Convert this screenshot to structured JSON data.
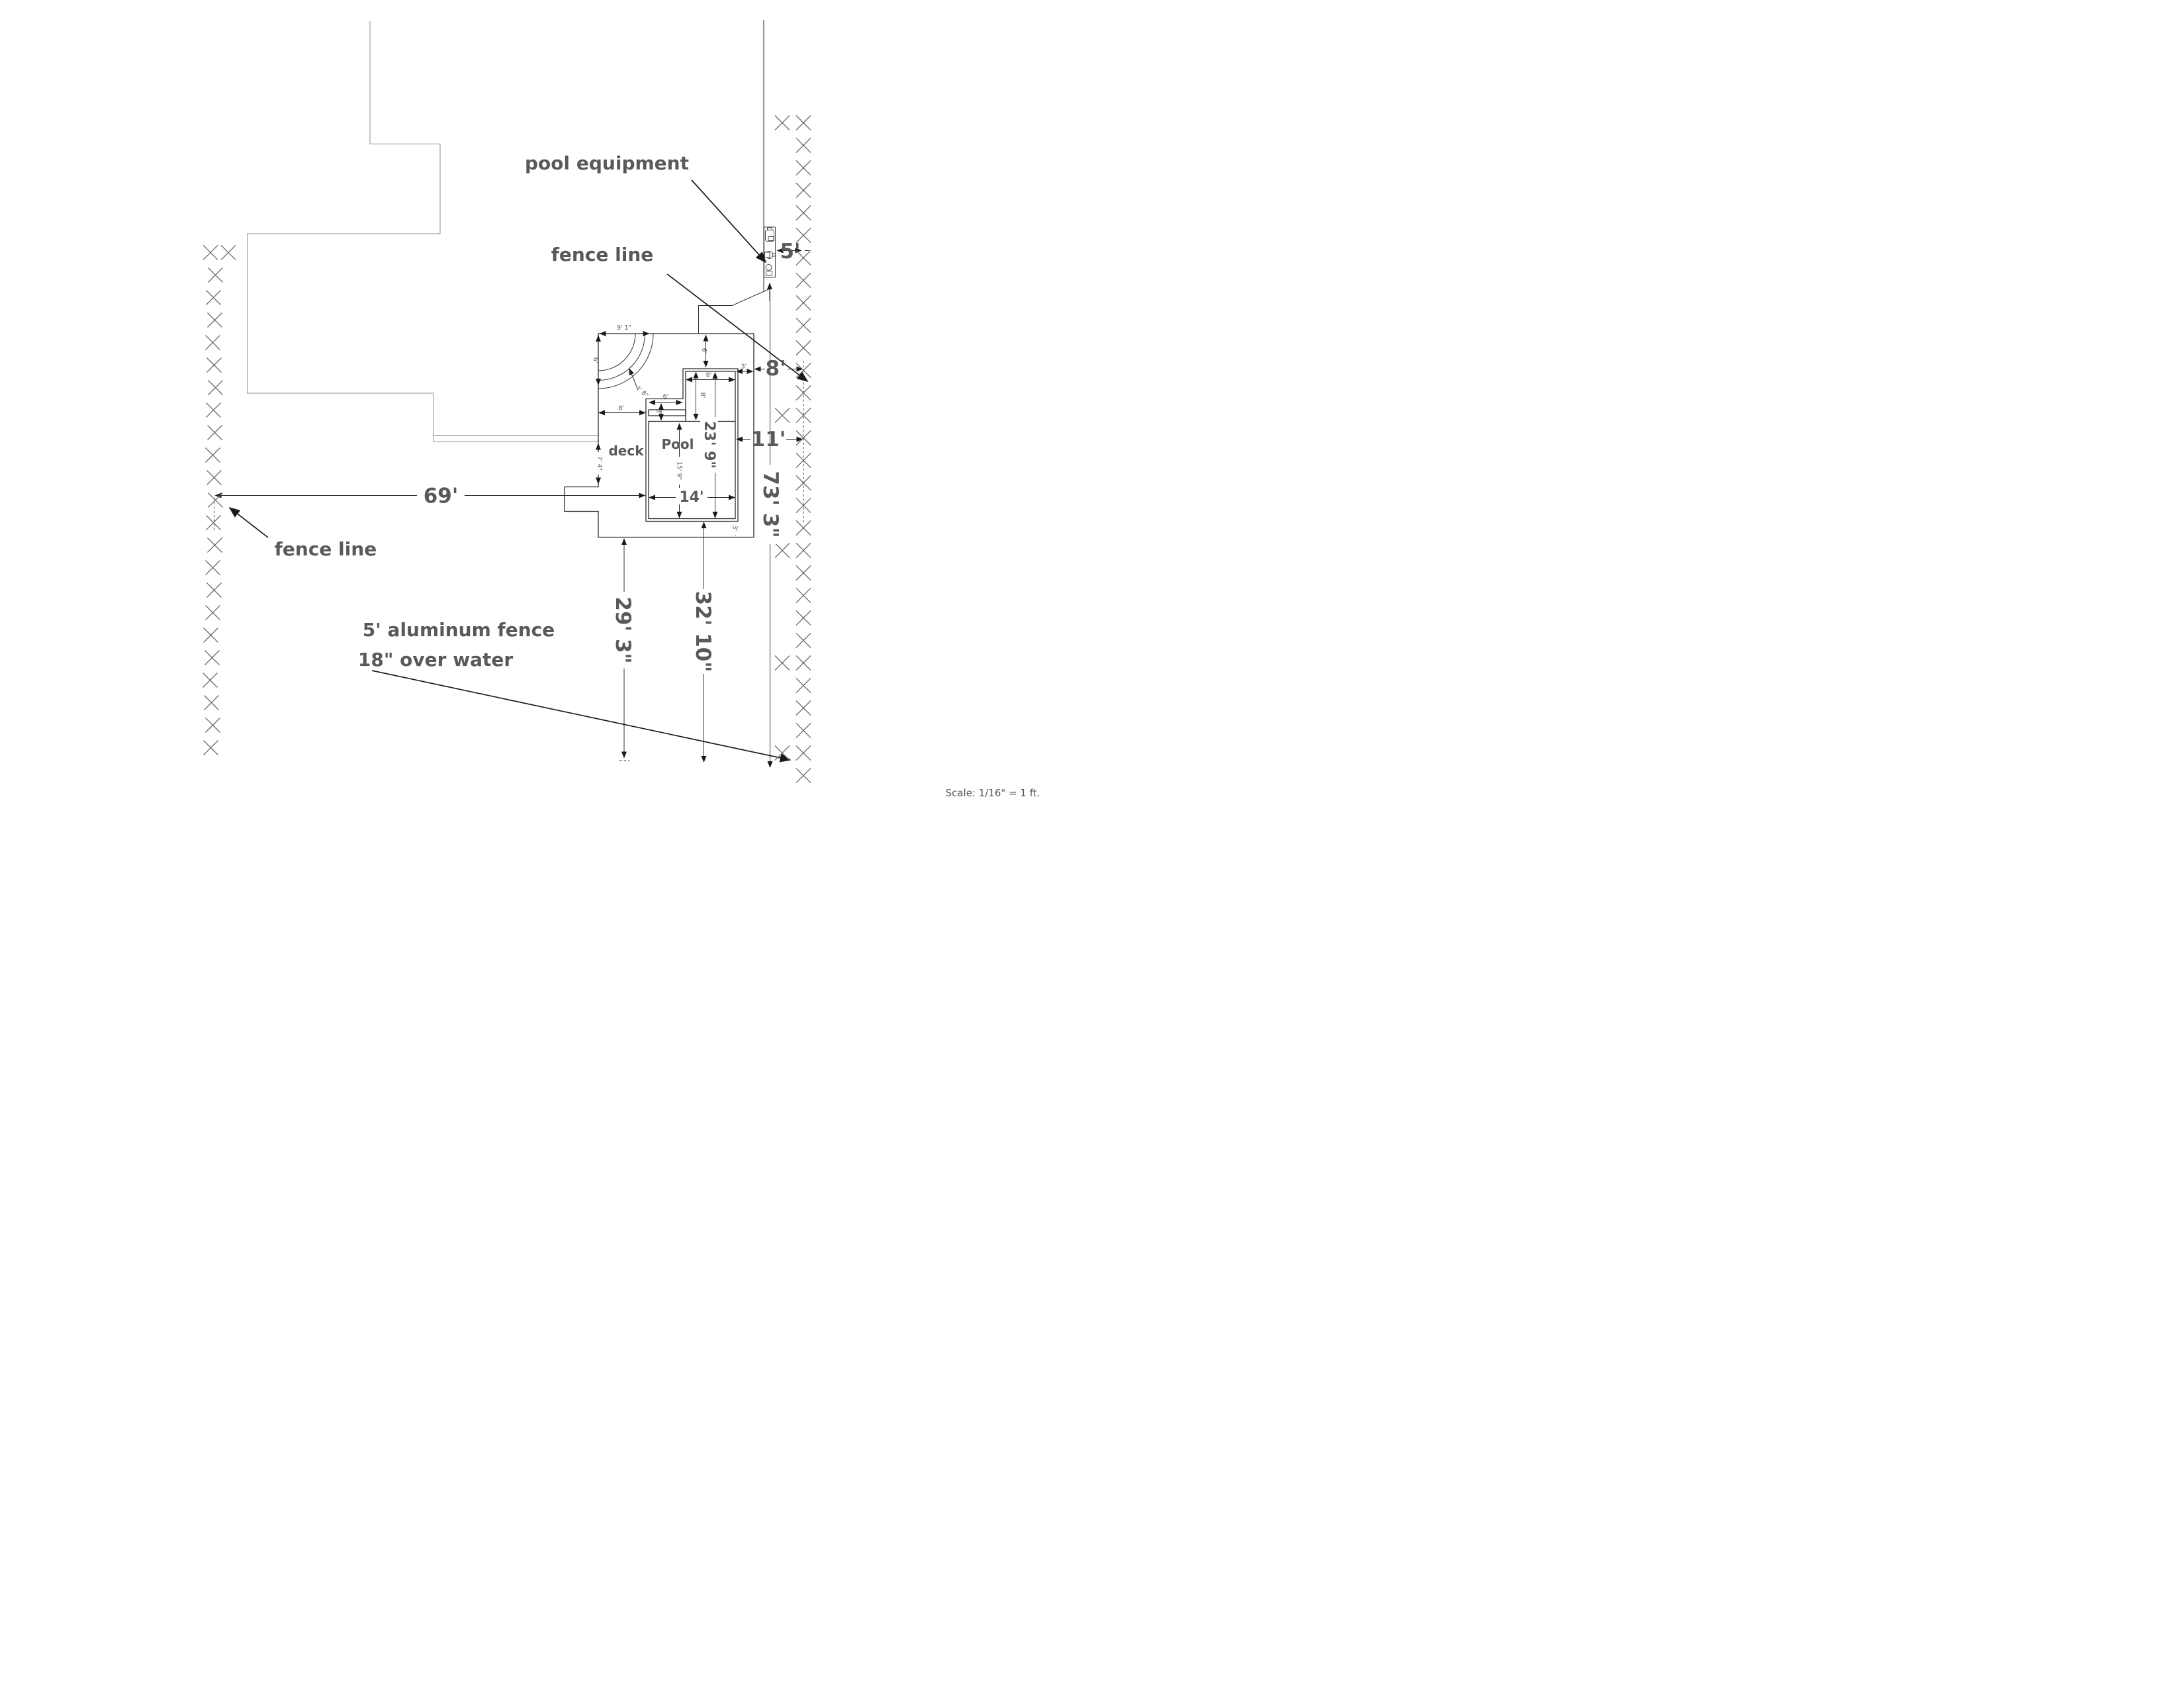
{
  "labels": {
    "pool_equipment": "pool equipment",
    "fence_line_upper": "fence line",
    "fence_line_lower": "fence line",
    "note_line1": "5' aluminum fence",
    "note_line2": "18\" over water",
    "pool": "Pool",
    "deck": "deck",
    "scale_note": "Scale: 1/16\" = 1 ft."
  },
  "dimensions": {
    "deck_top_width": "9' 1\"",
    "deck_left_upper": "6'",
    "corner_steps": "4' 8\"",
    "deck_to_spa_top": "6'",
    "spa_width": "8'",
    "spa_length": "8'",
    "pool_total_length": "23' 9\"",
    "step_width": "6'",
    "step_depth": "3'",
    "deck_to_pool_left": "8'",
    "deck_left_lower": "7' 4\"",
    "pool_main_length": "15' 9\"",
    "pool_width": "14'",
    "spa_to_deck_right": "3'",
    "pool_to_deck_bottom": "3'",
    "deck_to_south": "29' 3\"",
    "pool_to_south": "32' 10\"",
    "property_line_length": "73' 3\"",
    "fence_to_pool_west": "69'",
    "deck_to_fence_east": "8'",
    "pool_to_fence_east": "11'",
    "equipment_strip": "5'"
  },
  "colors": {
    "annotation_text": "#595959",
    "line_work": "#2b2b2b",
    "fence_marks": "#6e6e6e",
    "house_outline": "#8c8c8c"
  }
}
